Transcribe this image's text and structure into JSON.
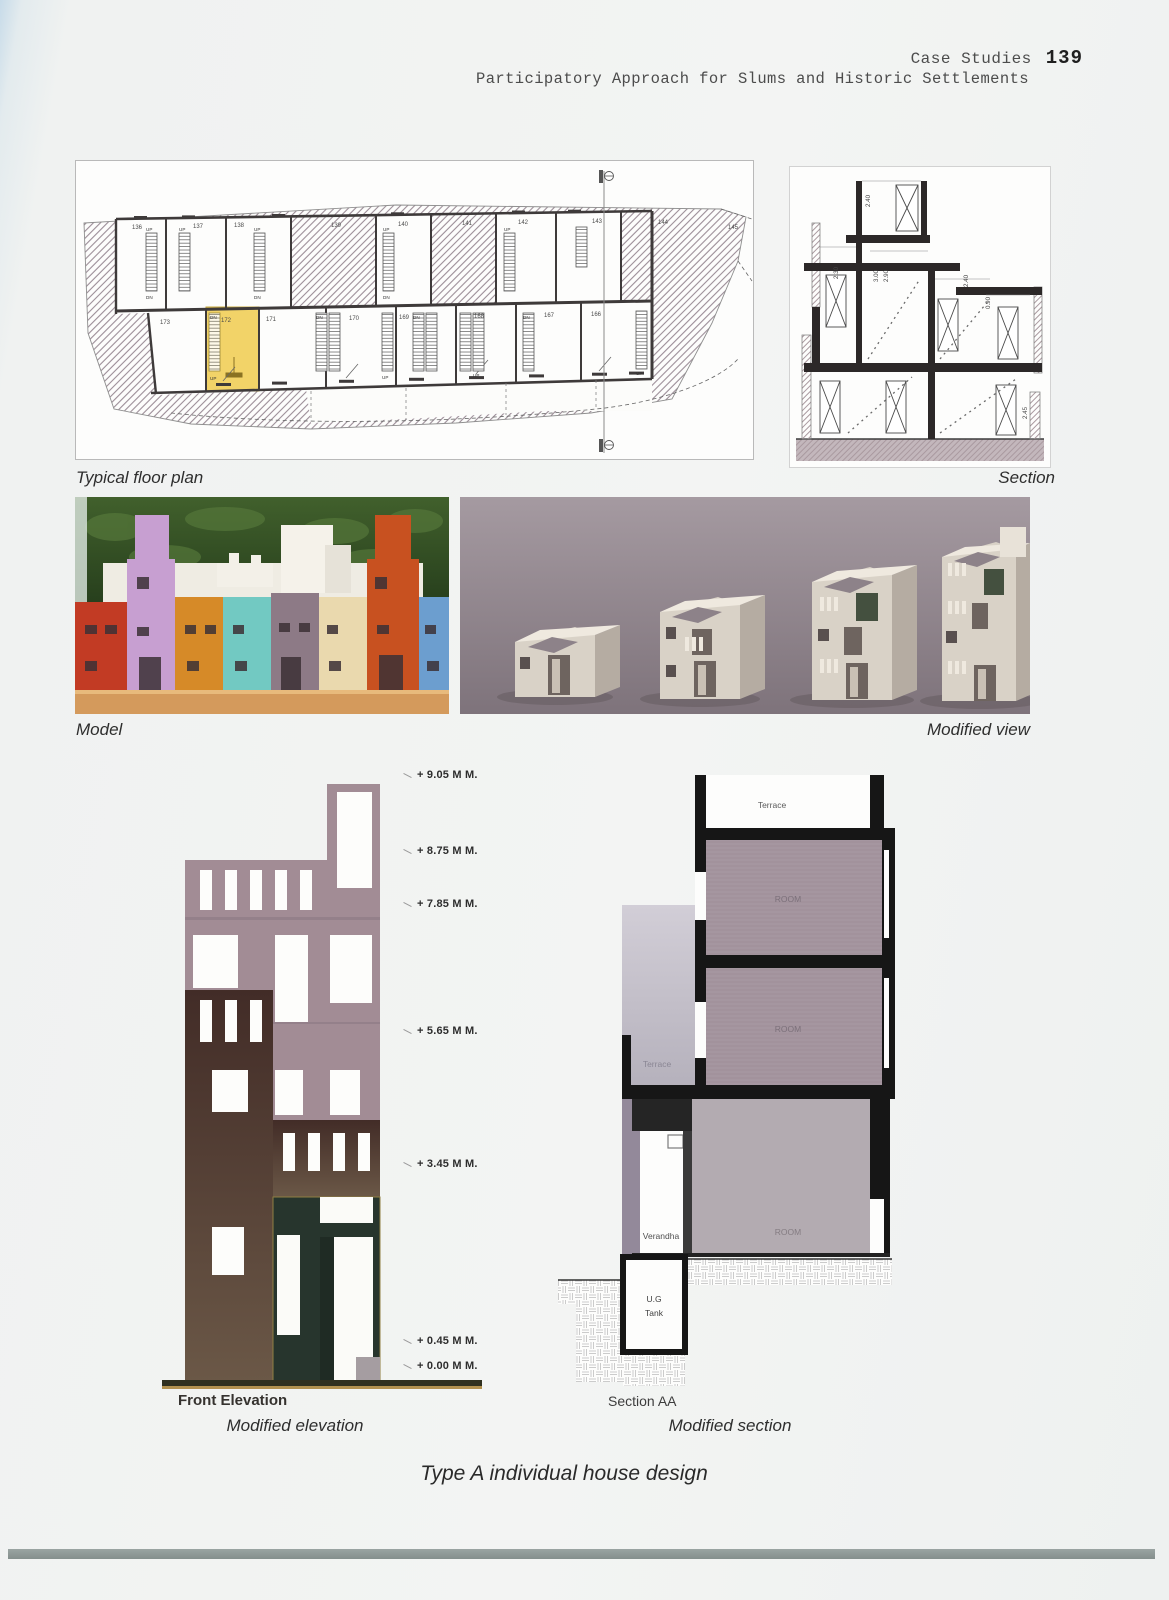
{
  "header": {
    "title": "Case Studies",
    "page_number": "139",
    "subtitle": "Participatory Approach for Slums and Historic Settlements"
  },
  "figures": {
    "floor_plan": {
      "caption": "Typical floor plan",
      "unit_numbers_top": [
        "136",
        "137",
        "138",
        "139",
        "140",
        "141",
        "142",
        "143",
        "144",
        "145"
      ],
      "unit_numbers_bottom": [
        "173",
        "172",
        "171",
        "170",
        "169",
        "168",
        "167",
        "166"
      ],
      "highlighted_unit": "172",
      "stair_up": "UP",
      "stair_dn": "DN",
      "highlight_color": "#f2d368"
    },
    "section": {
      "caption": "Section",
      "dim_tower": "2.40",
      "dim_left": "2.30",
      "dim_mid1": "3.00",
      "dim_mid2": "2.90",
      "dim_right": "2.40",
      "dim_parapet": "0.90",
      "dim_bottom": "2.45"
    },
    "model": {
      "caption": "Model",
      "house_colors": [
        "#c23b24",
        "#c79fd1",
        "#d68a28",
        "#72c9c2",
        "#8d7a86",
        "#ead9ae",
        "#c85120",
        "#6c9ecf"
      ]
    },
    "modified_view": {
      "caption": "Modified view"
    },
    "modified_elevation": {
      "caption": "Modified elevation",
      "drawing_label": "Front Elevation",
      "level_markers": [
        "+ 9.05 M M.",
        "+ 8.75 M M.",
        "+ 7.85 M M.",
        "+ 5.65 M M.",
        "+ 3.45 M M.",
        "+ 0.45 M M.",
        "+ 0.00 M M."
      ],
      "facade_color": "#a28c95",
      "lower_color": "#48312b",
      "entry_color": "#27352d"
    },
    "modified_section": {
      "caption": "Modified section",
      "drawing_label": "Section AA",
      "terrace_top": "Terrace",
      "room1": "ROOM",
      "terrace_mid": "Terrace",
      "room2": "ROOM",
      "verandha": "Verandha",
      "room3": "ROOM",
      "tank_line1": "U.G",
      "tank_line2": "Tank"
    }
  },
  "footer_caption": "Type A individual house design"
}
